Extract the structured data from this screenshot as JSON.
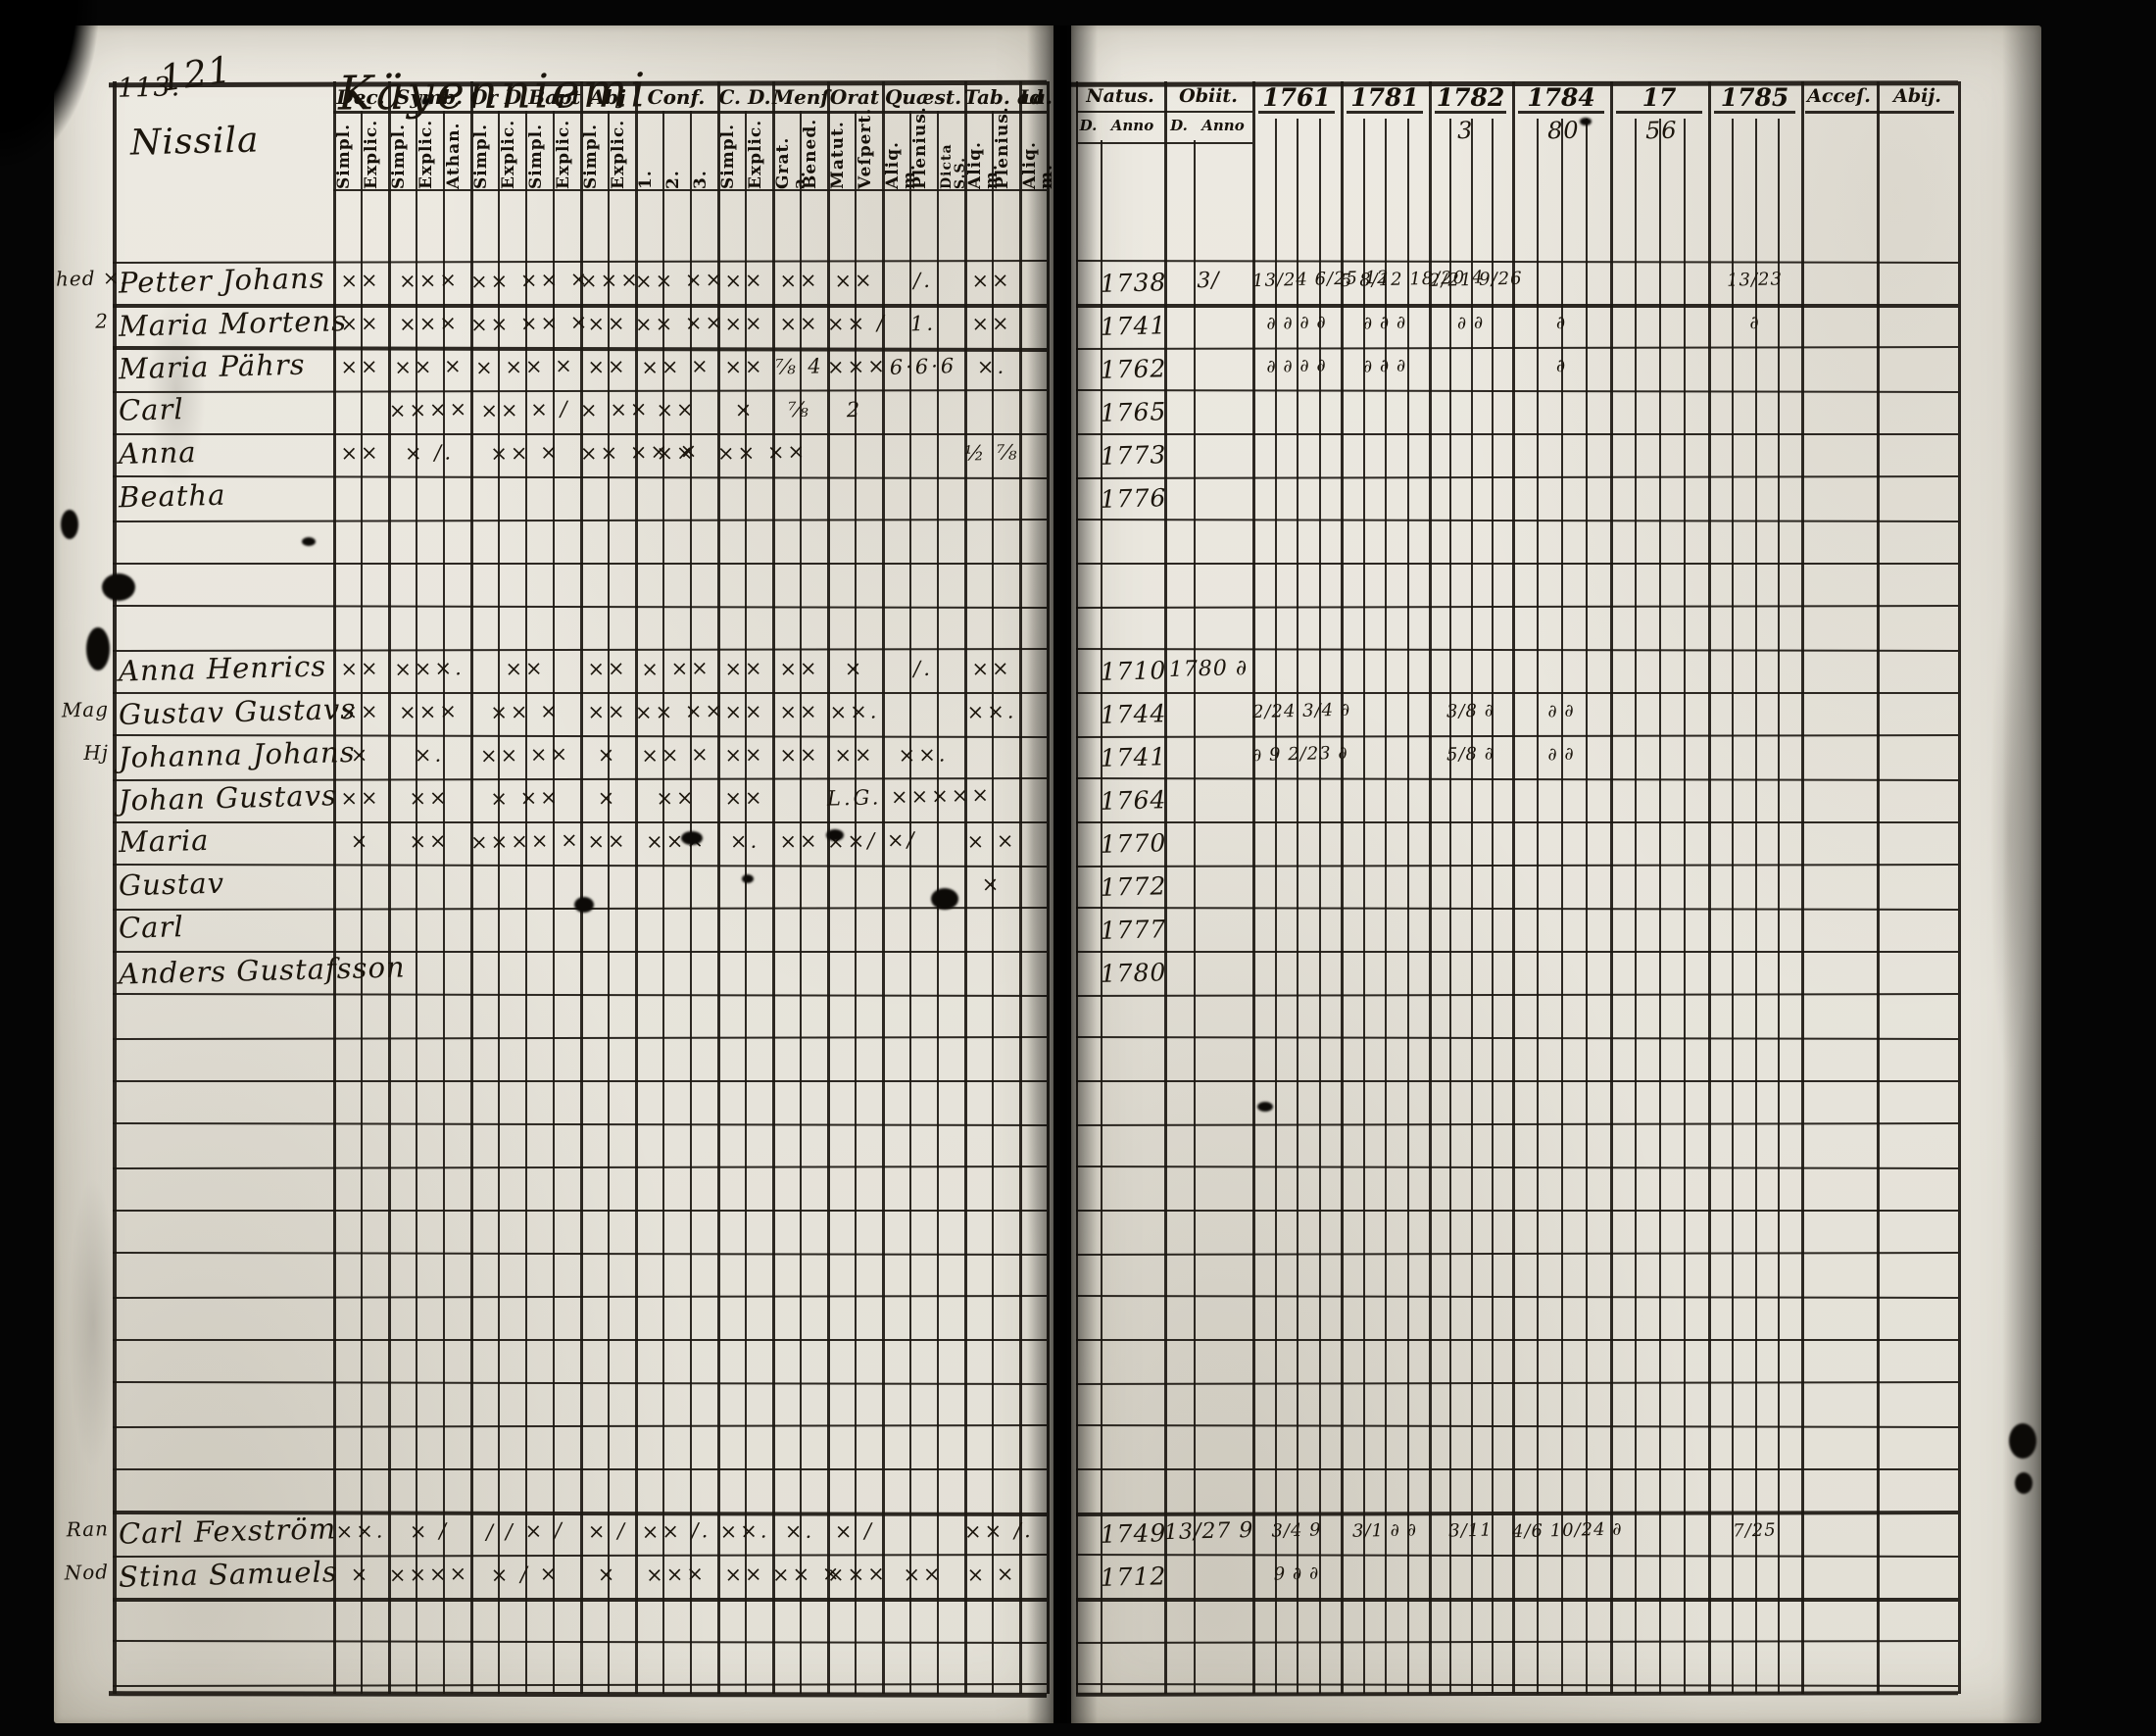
{
  "scan": {
    "page_number_left": "113.",
    "folio_number": "121",
    "title": "Käyenniemi",
    "village": "Nissila",
    "paper_color": "#e9e6de",
    "ink_color": "#1c1812"
  },
  "left_table": {
    "groups": [
      {
        "label": "Dec.",
        "subs": [
          "Simpl.",
          "Explic."
        ]
      },
      {
        "label": "Symb.",
        "subs": [
          "Simpl.",
          "Explic.",
          "Athan."
        ]
      },
      {
        "label": "Or D Bapt",
        "subs": [
          "Simpl.",
          "Explic.",
          "Simpl.",
          "Explic."
        ]
      },
      {
        "label": "Abj",
        "subs": [
          "Simpl.",
          "Explic."
        ]
      },
      {
        "label": "Conf.",
        "subs": [
          "1.",
          "2.",
          "3."
        ]
      },
      {
        "label": "C. D.",
        "subs": [
          "Simpl.",
          "Explic."
        ]
      },
      {
        "label": "Menſ",
        "subs": [
          "Grat. a.",
          "Bened."
        ]
      },
      {
        "label": "Orat",
        "subs": [
          "Matut.",
          "Veſpert."
        ]
      },
      {
        "label": "Quæst.",
        "subs": [
          "Aliq. m.",
          "Plenius.",
          "Dicta S.S."
        ]
      },
      {
        "label": "Tab. ad",
        "subs": [
          "Aliq. m.",
          "Plenius."
        ]
      },
      {
        "label": "La.",
        "subs": [
          "Aliq. m."
        ]
      }
    ]
  },
  "right_table": {
    "natus_label": "Natus.",
    "obiit_label": "Obiit.",
    "day_label": "D.",
    "anno_label": "Anno",
    "years": [
      {
        "label": "1761",
        "annotation": ""
      },
      {
        "label": "1781",
        "annotation": ""
      },
      {
        "label": "1782",
        "annotation": "3"
      },
      {
        "label": "1784",
        "annotation": "80"
      },
      {
        "label": "17",
        "annotation": "56"
      },
      {
        "label": "1785",
        "annotation": ""
      }
    ],
    "accessit_label": "Acceſ.",
    "abiit_label": "Abij."
  },
  "row_count": 33,
  "rows": [
    {
      "idx": 0,
      "margin": "hed ×.",
      "name": "Petter Johans",
      "marks": [
        "××",
        "×××",
        "×× ×× ×",
        "×××",
        "×× ××",
        "××",
        "××",
        "××",
        "∕.",
        "××",
        ""
      ],
      "natus": "1738",
      "obiit": "3∕",
      "year_marks": [
        "13/24 6/25 12",
        "5 8/12 18/20 4",
        "2/21 9/26",
        "",
        "",
        "13/23"
      ]
    },
    {
      "idx": 1,
      "margin": "2",
      "name": "Maria Mortens",
      "marks": [
        "××",
        "×××",
        "×× ×× ×",
        "××",
        "×× ××",
        "××",
        "××",
        "×× ∕",
        "1.",
        "××",
        ""
      ],
      "natus": "1741",
      "obiit": "",
      "year_marks": [
        "∂ ∂ ∂ ∂",
        "∂ ∂ ∂",
        "∂ ∂",
        "∂",
        "",
        "∂"
      ]
    },
    {
      "idx": 2,
      "margin": "",
      "name": "Maria Pährs",
      "marks": [
        "××",
        "×× ×",
        "× ×× ×",
        "××",
        "×× ×",
        "××",
        "⅞ 4",
        "×××",
        "6·6·6",
        "×.",
        ""
      ],
      "natus": "1762",
      "obiit": "",
      "year_marks": [
        "∂ ∂ ∂ ∂",
        "∂ ∂ ∂",
        "",
        "∂",
        "",
        ""
      ]
    },
    {
      "idx": 3,
      "margin": "",
      "name": "Carl",
      "marks": [
        "",
        "××××",
        "×× × ∕",
        "× ××",
        "××",
        "×",
        "⅞",
        "2",
        "",
        "",
        ""
      ],
      "natus": "1765",
      "obiit": "",
      "year_marks": [
        "",
        "",
        "",
        "",
        "",
        ""
      ]
    },
    {
      "idx": 4,
      "margin": "",
      "name": "Anna",
      "marks": [
        "××",
        "× ∕.",
        "×× ×",
        "×× ×× ×",
        "××",
        "×× ××",
        "",
        "",
        "",
        "½ ⅞",
        ""
      ],
      "natus": "1773",
      "obiit": "",
      "year_marks": [
        "",
        "",
        "",
        "",
        "",
        ""
      ]
    },
    {
      "idx": 5,
      "margin": "",
      "name": "Beatha",
      "marks": [
        "",
        "",
        "",
        "",
        "",
        "",
        "",
        "",
        "",
        "",
        ""
      ],
      "natus": "1776",
      "obiit": "",
      "year_marks": [
        "",
        "",
        "",
        "",
        "",
        ""
      ]
    },
    {
      "idx": 9,
      "margin": "",
      "name": "Anna Henrics",
      "marks": [
        "××",
        "×××.",
        "××",
        "××",
        "× ××",
        "××",
        "××",
        "×",
        "∕.",
        "××",
        ""
      ],
      "natus": "1710",
      "obiit": "1780 ∂",
      "year_marks": [
        "",
        "",
        "",
        "",
        "",
        ""
      ]
    },
    {
      "idx": 10,
      "margin": "Mag",
      "name": "Gustav Gustavs",
      "marks": [
        "××",
        "×××",
        "×× ×",
        "××",
        "×× ××",
        "××",
        "××",
        "××.",
        "",
        "××.",
        ""
      ],
      "natus": "1744",
      "obiit": "",
      "year_marks": [
        "2/24 3/4 ∂",
        "",
        "3/8 ∂",
        "∂ ∂",
        "",
        ""
      ]
    },
    {
      "idx": 11,
      "margin": "Hj",
      "name": "Johanna Johans",
      "marks": [
        "×",
        "×.",
        "×× ××",
        "×",
        "×× ×",
        "××",
        "××",
        "××",
        "××.",
        "",
        ""
      ],
      "natus": "1741",
      "obiit": "",
      "year_marks": [
        "∂ 9 2/23 ∂",
        "",
        "5/8 ∂",
        "∂ ∂",
        "",
        ""
      ]
    },
    {
      "idx": 12,
      "margin": "",
      "name": "Johan Gustavs",
      "marks": [
        "××",
        "××",
        "× ××",
        "×",
        "××",
        "××",
        "",
        "L.G. ×××××",
        "",
        "",
        ""
      ],
      "natus": "1764",
      "obiit": "",
      "year_marks": [
        "",
        "",
        "",
        "",
        "",
        ""
      ]
    },
    {
      "idx": 13,
      "margin": "",
      "name": "Maria",
      "marks": [
        "×",
        "××",
        "×××× ×",
        "××",
        "×××",
        "×.",
        "××",
        "××∕ ×∕",
        "",
        "× ×",
        ""
      ],
      "natus": "1770",
      "obiit": "",
      "year_marks": [
        "",
        "",
        "",
        "",
        "",
        ""
      ]
    },
    {
      "idx": 14,
      "margin": "",
      "name": "Gustav",
      "marks": [
        "",
        "",
        "",
        "",
        "",
        "",
        "",
        "",
        "",
        "×",
        ""
      ],
      "natus": "1772",
      "obiit": "",
      "year_marks": [
        "",
        "",
        "",
        "",
        "",
        ""
      ]
    },
    {
      "idx": 15,
      "margin": "",
      "name": "Carl",
      "marks": [
        "",
        "",
        "",
        "",
        "",
        "",
        "",
        "",
        "",
        "",
        ""
      ],
      "natus": "1777",
      "obiit": "",
      "year_marks": [
        "",
        "",
        "",
        "",
        "",
        ""
      ]
    },
    {
      "idx": 16,
      "margin": "",
      "name": "Anders Gustafsson",
      "marks": [
        "",
        "",
        "",
        "",
        "",
        "",
        "",
        "",
        "",
        "",
        ""
      ],
      "natus": "1780",
      "obiit": "",
      "year_marks": [
        "",
        "",
        "",
        "",
        "",
        ""
      ]
    },
    {
      "idx": 29,
      "margin": "Ran",
      "name": "Carl Fexström",
      "marks": [
        "××.",
        "× ∕",
        "∕ ∕ × ∕",
        "× ∕",
        "×× ∕.",
        "××.",
        "×.",
        "× ∕",
        "",
        "×× ∕.",
        ""
      ],
      "natus": "1749",
      "obiit": "13/27 9",
      "year_marks": [
        "3/4 9",
        "3/1 ∂ ∂",
        "3/11",
        "4/6 10/24 ∂",
        "",
        "7/25"
      ]
    },
    {
      "idx": 30,
      "margin": "Nod",
      "name": "Stina Samuels",
      "marks": [
        "×",
        "××××",
        "× ∕ ×",
        "×",
        "×××",
        "××",
        "×× ×",
        "×××",
        "××",
        "× ×",
        ""
      ],
      "natus": "1712",
      "obiit": "",
      "year_marks": [
        "9 ∂ ∂",
        "",
        "",
        "",
        "",
        ""
      ]
    }
  ]
}
